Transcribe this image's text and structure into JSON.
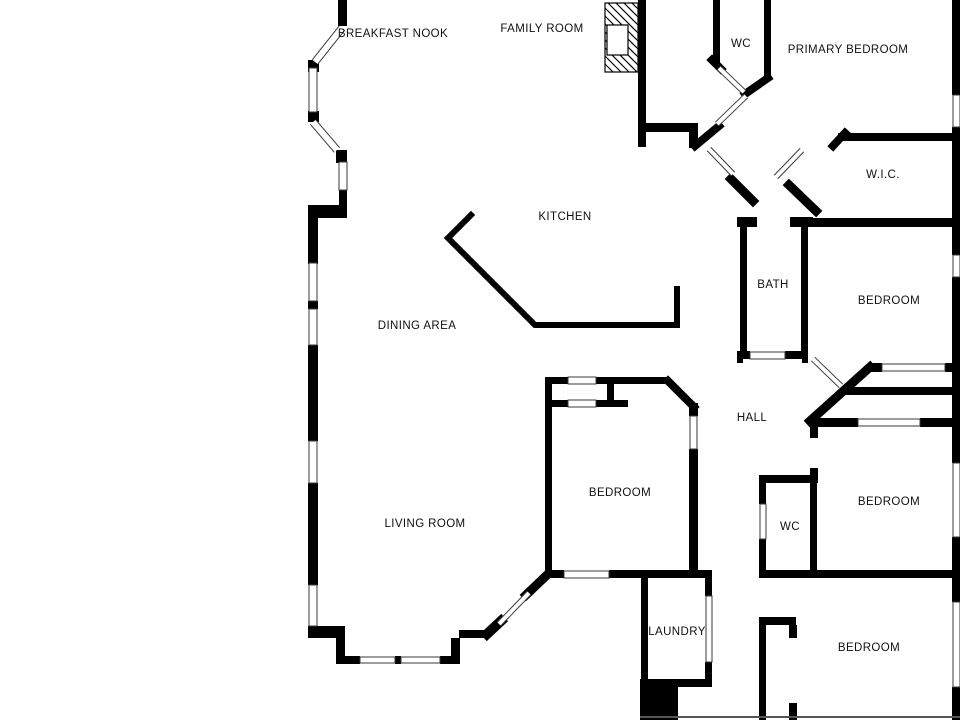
{
  "title": "Floor plan",
  "colors": {
    "background": "#ffffff",
    "wall": "#000000",
    "window_edge": "#3a3a3a",
    "label": "#111111",
    "thin_line": "#555555"
  },
  "rooms": [
    {
      "id": "breakfast-nook",
      "label": "BREAKFAST NOOK",
      "x": 393,
      "y": 37
    },
    {
      "id": "family-room",
      "label": "FAMILY ROOM",
      "x": 542,
      "y": 32
    },
    {
      "id": "wc-top",
      "label": "WC",
      "x": 741,
      "y": 47
    },
    {
      "id": "primary-bedroom",
      "label": "PRIMARY BEDROOM",
      "x": 848,
      "y": 53
    },
    {
      "id": "wic",
      "label": "W.I.C.",
      "x": 883,
      "y": 178
    },
    {
      "id": "kitchen",
      "label": "KITCHEN",
      "x": 565,
      "y": 220
    },
    {
      "id": "bath",
      "label": "BATH",
      "x": 773,
      "y": 288
    },
    {
      "id": "bedroom-upper-right",
      "label": "BEDROOM",
      "x": 889,
      "y": 304
    },
    {
      "id": "dining-area",
      "label": "DINING AREA",
      "x": 417,
      "y": 329
    },
    {
      "id": "hall",
      "label": "HALL",
      "x": 752,
      "y": 421
    },
    {
      "id": "bedroom-middle",
      "label": "BEDROOM",
      "x": 620,
      "y": 496
    },
    {
      "id": "bedroom-right",
      "label": "BEDROOM",
      "x": 889,
      "y": 505
    },
    {
      "id": "wc-bottom",
      "label": "WC",
      "x": 790,
      "y": 530
    },
    {
      "id": "living-room",
      "label": "LIVING ROOM",
      "x": 425,
      "y": 527
    },
    {
      "id": "laundry",
      "label": "LAUNDRY",
      "x": 677,
      "y": 635
    },
    {
      "id": "bedroom-bottom",
      "label": "BEDROOM",
      "x": 869,
      "y": 651
    }
  ],
  "geometry": {
    "wall_rects": [
      [
        338,
        0,
        9,
        26
      ],
      [
        308,
        60,
        11,
        12
      ],
      [
        308,
        111,
        11,
        11
      ],
      [
        336,
        150,
        11,
        13
      ],
      [
        339,
        189,
        8,
        17
      ],
      [
        308,
        205,
        39,
        13
      ],
      [
        308,
        218,
        10,
        46
      ],
      [
        308,
        301,
        10,
        8
      ],
      [
        308,
        345,
        10,
        96
      ],
      [
        308,
        483,
        10,
        102
      ],
      [
        308,
        626,
        37,
        12
      ],
      [
        336,
        638,
        9,
        26
      ],
      [
        343,
        656,
        17,
        8
      ],
      [
        395,
        656,
        6,
        8
      ],
      [
        440,
        656,
        20,
        8
      ],
      [
        451,
        638,
        9,
        26
      ],
      [
        459,
        630,
        29,
        8
      ],
      [
        545,
        377,
        7,
        200
      ],
      [
        545,
        377,
        23,
        7
      ],
      [
        596,
        377,
        74,
        7
      ],
      [
        607,
        377,
        7,
        29
      ],
      [
        551,
        400,
        17,
        7
      ],
      [
        596,
        400,
        32,
        7
      ],
      [
        689,
        403,
        9,
        13
      ],
      [
        689,
        449,
        9,
        128
      ],
      [
        545,
        570,
        19,
        8
      ],
      [
        609,
        570,
        34,
        8
      ],
      [
        643,
        570,
        69,
        8
      ],
      [
        641,
        578,
        7,
        104
      ],
      [
        705,
        578,
        7,
        18
      ],
      [
        705,
        662,
        7,
        20
      ],
      [
        672,
        679,
        40,
        8
      ],
      [
        640,
        679,
        38,
        41
      ],
      [
        638,
        0,
        8,
        147
      ],
      [
        638,
        123,
        60,
        9
      ],
      [
        689,
        132,
        9,
        16
      ],
      [
        713,
        0,
        7,
        63
      ],
      [
        764,
        0,
        7,
        78
      ],
      [
        737,
        217,
        20,
        10
      ],
      [
        790,
        217,
        23,
        10
      ],
      [
        740,
        217,
        7,
        141
      ],
      [
        801,
        217,
        7,
        136
      ],
      [
        737,
        351,
        13,
        8
      ],
      [
        785,
        351,
        23,
        8
      ],
      [
        737,
        351,
        6,
        12
      ],
      [
        802,
        351,
        6,
        12
      ],
      [
        838,
        133,
        122,
        8
      ],
      [
        790,
        218,
        170,
        9
      ],
      [
        870,
        363,
        12,
        9
      ],
      [
        945,
        363,
        15,
        9
      ],
      [
        845,
        387,
        115,
        8
      ],
      [
        810,
        418,
        48,
        9
      ],
      [
        920,
        418,
        40,
        9
      ],
      [
        810,
        420,
        8,
        18
      ],
      [
        810,
        468,
        8,
        15
      ],
      [
        759,
        475,
        58,
        8
      ],
      [
        759,
        483,
        7,
        21
      ],
      [
        759,
        539,
        7,
        38
      ],
      [
        810,
        475,
        7,
        102
      ],
      [
        759,
        570,
        201,
        8
      ],
      [
        759,
        617,
        7,
        103
      ],
      [
        766,
        617,
        30,
        8
      ],
      [
        789,
        625,
        8,
        13
      ],
      [
        789,
        703,
        8,
        17
      ],
      [
        952,
        0,
        8,
        95
      ],
      [
        952,
        127,
        8,
        128
      ],
      [
        952,
        277,
        8,
        186
      ],
      [
        952,
        537,
        8,
        65
      ],
      [
        952,
        687,
        8,
        33
      ]
    ],
    "diag_walls": [
      [
        487,
        634,
        501,
        621,
        10
      ],
      [
        526,
        595,
        548,
        574,
        9
      ],
      [
        668,
        381,
        694,
        407,
        8
      ],
      [
        695,
        146,
        719,
        126,
        8
      ],
      [
        712,
        60,
        721,
        69,
        8
      ],
      [
        768,
        78,
        745,
        94,
        8
      ],
      [
        731,
        179,
        753,
        201,
        9
      ],
      [
        789,
        185,
        816,
        211,
        9
      ],
      [
        833,
        146,
        845,
        133,
        8
      ],
      [
        810,
        421,
        870,
        367,
        9
      ]
    ],
    "window_rects": [
      [
        309,
        68,
        8,
        44
      ],
      [
        339,
        162,
        8,
        28
      ],
      [
        309,
        263,
        8,
        38
      ],
      [
        309,
        309,
        8,
        36
      ],
      [
        309,
        441,
        8,
        42
      ],
      [
        309,
        585,
        8,
        41
      ],
      [
        360,
        657,
        35,
        6
      ],
      [
        401,
        657,
        39,
        6
      ],
      [
        568,
        377,
        28,
        7
      ],
      [
        568,
        400,
        28,
        7
      ],
      [
        564,
        571,
        45,
        7
      ],
      [
        706,
        596,
        6,
        66
      ],
      [
        750,
        352,
        35,
        7
      ],
      [
        882,
        364,
        63,
        7
      ],
      [
        858,
        419,
        62,
        7
      ],
      [
        953,
        95,
        7,
        32
      ],
      [
        953,
        255,
        7,
        22
      ],
      [
        953,
        463,
        7,
        74
      ],
      [
        953,
        602,
        7,
        85
      ],
      [
        760,
        504,
        6,
        35
      ],
      [
        690,
        416,
        7,
        33
      ]
    ],
    "diag_windows": [
      [
        342,
        28,
        315,
        62
      ],
      [
        313,
        122,
        337,
        150
      ]
    ],
    "door_leaves": [
      [
        499,
        624,
        529,
        593
      ],
      [
        717,
        124,
        746,
        96
      ],
      [
        719,
        68,
        744,
        92
      ],
      [
        709,
        149,
        733,
        174
      ],
      [
        776,
        177,
        802,
        150
      ],
      [
        813,
        359,
        841,
        386
      ]
    ],
    "counter_points": [
      [
        471,
        215
      ],
      [
        448,
        238
      ],
      [
        535,
        325
      ],
      [
        677,
        325
      ],
      [
        677,
        289
      ]
    ],
    "fireplace": {
      "outer": [
        605,
        3,
        33,
        69
      ],
      "inner": [
        607,
        25,
        21,
        30
      ]
    },
    "thin_lines": [
      [
        640,
        716,
        320,
        2
      ]
    ]
  }
}
